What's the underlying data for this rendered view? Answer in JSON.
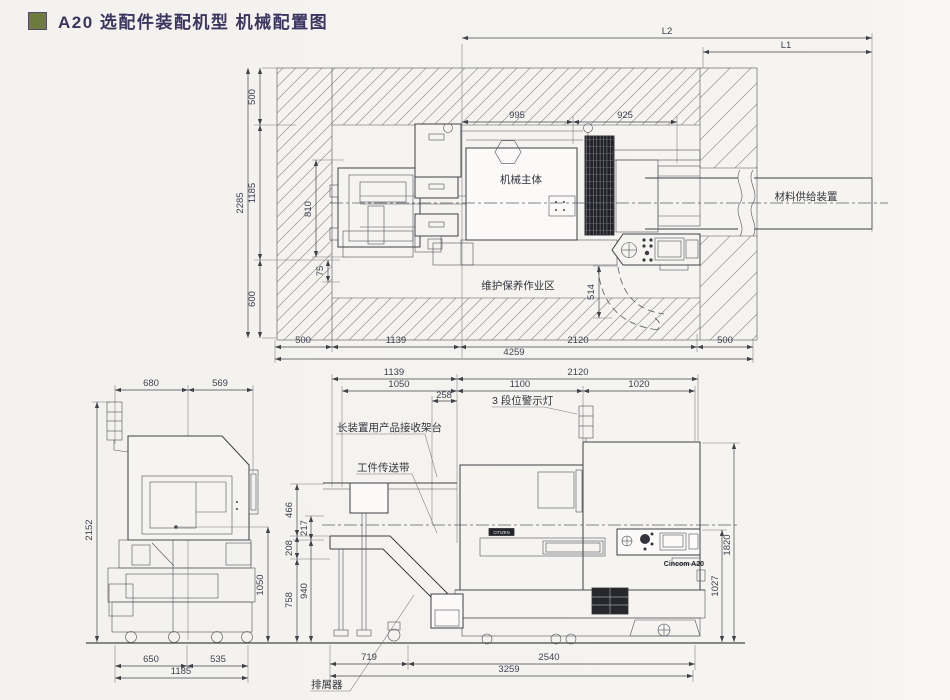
{
  "page": {
    "title": "A20 选配件装配机型 机械配置图",
    "accent_color": "#6e7b40",
    "title_color": "#3c3560"
  },
  "top_view": {
    "labels": {
      "machine_body": "机械主体",
      "material_supply": "材料供给装置",
      "maintenance_area": "维护保养作业区"
    },
    "dims": {
      "l2": "L2",
      "l1": "L1",
      "d995": "995",
      "d925": "925",
      "d500_top": "500",
      "d2285": "2285",
      "d1185": "1185",
      "d810": "810",
      "d75": "75",
      "d600": "600",
      "d514": "514",
      "d500_bl": "500",
      "d1139": "1139",
      "d2120": "2120",
      "d500_br": "500",
      "d4259": "4259"
    }
  },
  "side_view": {
    "dims": {
      "d680": "680",
      "d569": "569",
      "d2152": "2152",
      "d1050": "1050",
      "d650": "650",
      "d535": "535",
      "d1185": "1185"
    }
  },
  "front_view": {
    "labels": {
      "warning_light": "3 段位警示灯",
      "receiving_stand": "长装置用产品接收架台",
      "conveyor": "工件传送带",
      "chip_conveyor": "排屑器",
      "brand": "Cincom A20",
      "brand_tag": "CITIZEN"
    },
    "dims": {
      "d1139": "1139",
      "d2120": "2120",
      "d1050": "1050",
      "d1100": "1100",
      "d1020": "1020",
      "d258": "258",
      "d466": "466",
      "d217": "217",
      "d208": "208",
      "d758": "758",
      "d940": "940",
      "d719": "719",
      "d2540": "2540",
      "d3259": "3259",
      "d1820": "1820",
      "d1027": "1027"
    }
  }
}
